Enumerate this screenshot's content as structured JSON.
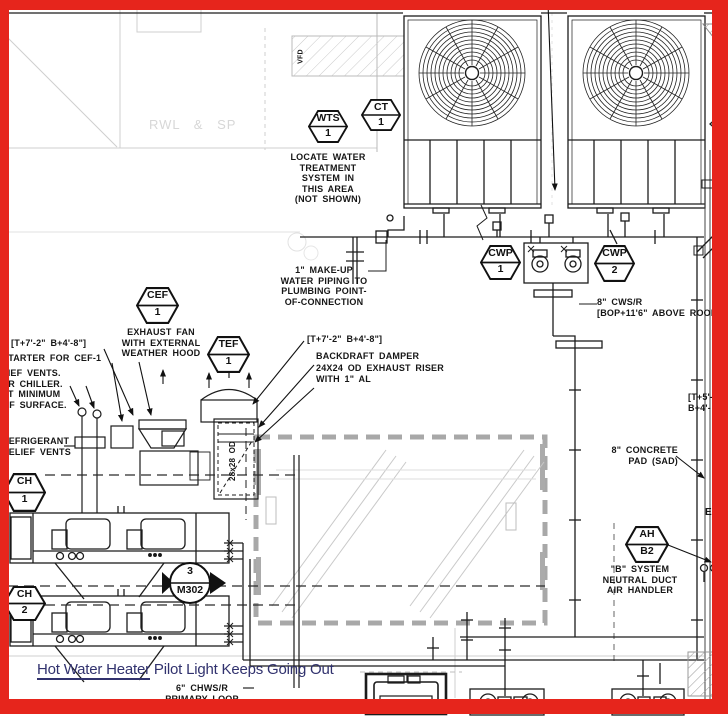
{
  "colors": {
    "border_red": "#e6251c",
    "overlay_blue": "#31326e",
    "line_black": "#1c1c1c",
    "faint_gray": "#cccccc",
    "well_gray": "#a8a8a8"
  },
  "callouts": {
    "wts": {
      "tag": "WTS",
      "num": "1"
    },
    "ct": {
      "tag": "CT",
      "num": "1"
    },
    "cef": {
      "tag": "CEF",
      "num": "1"
    },
    "tef": {
      "tag": "TEF",
      "num": "1"
    },
    "cwp1": {
      "tag": "CWP",
      "num": "1"
    },
    "cwp2": {
      "tag": "CWP",
      "num": "2"
    },
    "ch1": {
      "tag": "CH",
      "num": "1"
    },
    "ch2": {
      "tag": "CH",
      "num": "2"
    },
    "ah": {
      "tag": "AH",
      "num": "B2"
    }
  },
  "section_marker": {
    "number": "3",
    "sheet": "M302"
  },
  "notes": {
    "locate_water": "LOCATE WATER\nTREATMENT\nSYSTEM IN\nTHIS AREA\n(NOT SHOWN)",
    "makeup": "1\" MAKE-UP\nWATER PIPING TO\nPLUMBING POINT-\nOF-CONNECTION",
    "cws": "8\" CWS/R\n[BOP+11'6\" ABOVE ROOF]",
    "exhaust_fan": "EXHAUST FAN\nWITH EXTERNAL\nWEATHER HOOD",
    "bracket_left": "[T+7'-2\" B+4'-8\"]",
    "starter": "STARTER FOR CEF-1",
    "relief_partial": "LIEF VENTS.\nER CHILLER.\nAT MINIMUM\nOF SURFACE.",
    "refrigerant": "REFRIGERANT\nRELIEF VENTS",
    "bracket_tef": "[T+7'-2\" B+4'-8\"]",
    "backdraft": "BACKDRAFT DAMPER\n24X24 OD EXHAUST RISER\nWITH 1\" AL",
    "concrete_pad": "8\" CONCRETE\nPAD (SAD)",
    "bracket_right": "[T+5'-\nB+4'-",
    "b_system": "\"B\" SYSTEM\nNEUTRAL DUCT\nAIR HANDLER",
    "chws": "6\" CHWS/R\nPRIMARY LOOP\nPIPING",
    "duct_size": "28x28 OD",
    "vfd": "VFD",
    "rwl_sp": "RWL & SP",
    "edge_e": "E"
  },
  "overlay": {
    "underlined": "Hot Water Heater",
    "rest": " Pilot Light Keeps Going Out"
  }
}
